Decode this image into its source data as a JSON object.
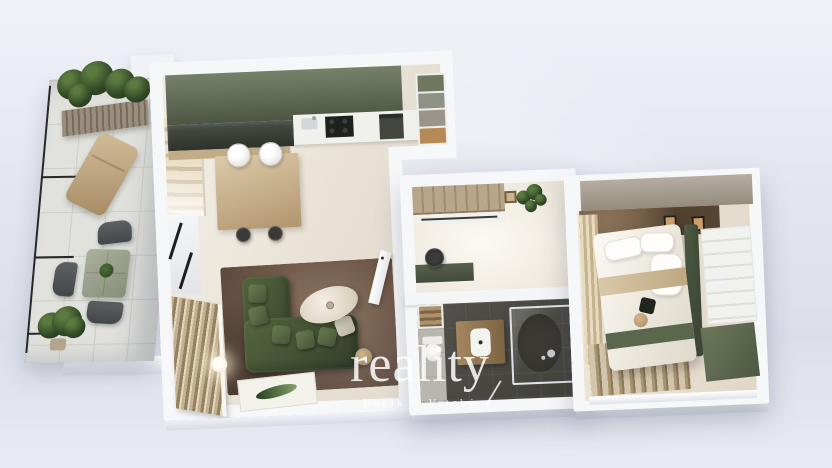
{
  "watermark": {
    "brand": "reality",
    "subtitle": "Horák & Vetchý",
    "slash": "/"
  },
  "palette": {
    "bg_top": "#f1f2f8",
    "bg_mid": "#e2e4ee",
    "bg_bottom": "#e9ebf2",
    "wall": "#f6f7f9",
    "floor": "#ece5d9",
    "kitchen_green": "#4d5642",
    "dark_glass": "#2d322b",
    "wood": "#c2ac88",
    "wood_dark": "#7c6443",
    "sofa_green": "#34402a",
    "rug_bronze": "#70594a",
    "marble": "#5a4836",
    "olive": "#4d5840",
    "bath_floor": "#3f3e39",
    "tile": "#e1e1dd",
    "curtain": "#c6b290",
    "taupe": "#948c7d",
    "plant": "#314825",
    "bed_white": "#fbf9f5",
    "watermark": "#ffffff"
  },
  "scene": {
    "type": "3d-floor-plan-render",
    "view": "top-down cutaway apartment visualization",
    "rooms": [
      {
        "name": "balcony",
        "items": [
          "planter-with-plants",
          "sun-lounger",
          "outdoor-table",
          "outdoor-chairs",
          "potted-plant",
          "railing",
          "tiled-floor"
        ]
      },
      {
        "name": "living-room-kitchen",
        "items": [
          "kitchen-upper-cabinets",
          "dark-glass-cabinet",
          "kitchen-counter",
          "sink",
          "cooktop",
          "built-in-appliance",
          "tall-shelf-unit",
          "dining-island",
          "white-chairs",
          "bar-stools",
          "green-corner-sofa",
          "cushions",
          "oval-coffee-table",
          "side-table",
          "sphere-floor-lamp",
          "bronze-area-rug",
          "leaf-print-rug",
          "roman-shade",
          "venetian-blind",
          "window",
          "interior-door"
        ]
      },
      {
        "name": "hallway-study",
        "items": [
          "wardrobe",
          "bench-base",
          "desk",
          "office-chair",
          "wall-plant",
          "wall-frame"
        ]
      },
      {
        "name": "bathroom",
        "items": [
          "towel-niche",
          "toilet",
          "wood-vanity-with-basin",
          "walk-in-glass-shower",
          "shower-fixture",
          "dark-tile-floor"
        ]
      },
      {
        "name": "bedroom",
        "items": [
          "double-bed",
          "pillows",
          "beige-throw",
          "green-runner",
          "dark-cushion",
          "round-cushion",
          "upholstered-headboard",
          "panel-wardrobe",
          "marble-accent-wall",
          "wall-frames",
          "curtains",
          "striped-rug",
          "olive-wall",
          "window"
        ]
      }
    ]
  }
}
